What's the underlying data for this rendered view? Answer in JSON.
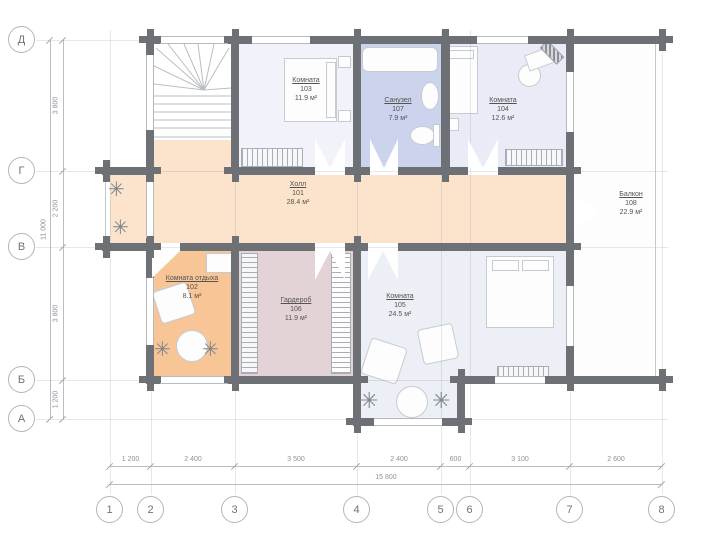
{
  "plan": {
    "rooms": {
      "hall": {
        "name": "Холл",
        "number": "101",
        "area": "28.4 м²"
      },
      "lounge": {
        "name": "Комната отдыха",
        "number": "102",
        "area": "8.1 м²"
      },
      "room103": {
        "name": "Комната",
        "number": "103",
        "area": "11.9 м²"
      },
      "room104": {
        "name": "Комната",
        "number": "104",
        "area": "12.6 м²"
      },
      "room105": {
        "name": "Комната",
        "number": "105",
        "area": "24.5 м²"
      },
      "wardrobe": {
        "name": "Гардероб",
        "number": "106",
        "area": "11.9 м²"
      },
      "bathroom": {
        "name": "Санузел",
        "number": "107",
        "area": "7.9 м²"
      },
      "balcony": {
        "name": "Балкон",
        "number": "108",
        "area": "22.9 м²"
      }
    },
    "grid": {
      "columns": [
        "1",
        "2",
        "3",
        "4",
        "5",
        "6",
        "7",
        "8"
      ],
      "rows": [
        "Д",
        "Г",
        "В",
        "Б",
        "А"
      ]
    },
    "dimensions": {
      "bottom": [
        "1 200",
        "2 400",
        "3 500",
        "2 400",
        "600",
        "3 100",
        "2 600"
      ],
      "bottom_total": "15 800",
      "left": [
        "3 800",
        "2 200",
        "3 800",
        "1 200"
      ],
      "left_total": "11 000"
    },
    "colors": {
      "wall": "#6d7175",
      "hall": "#fbe4cb",
      "lounge": "#f8c596",
      "wardrobe": "#e3d3d6",
      "bathroom": "#cbd3ed",
      "bedroom": "#edeff7"
    }
  }
}
